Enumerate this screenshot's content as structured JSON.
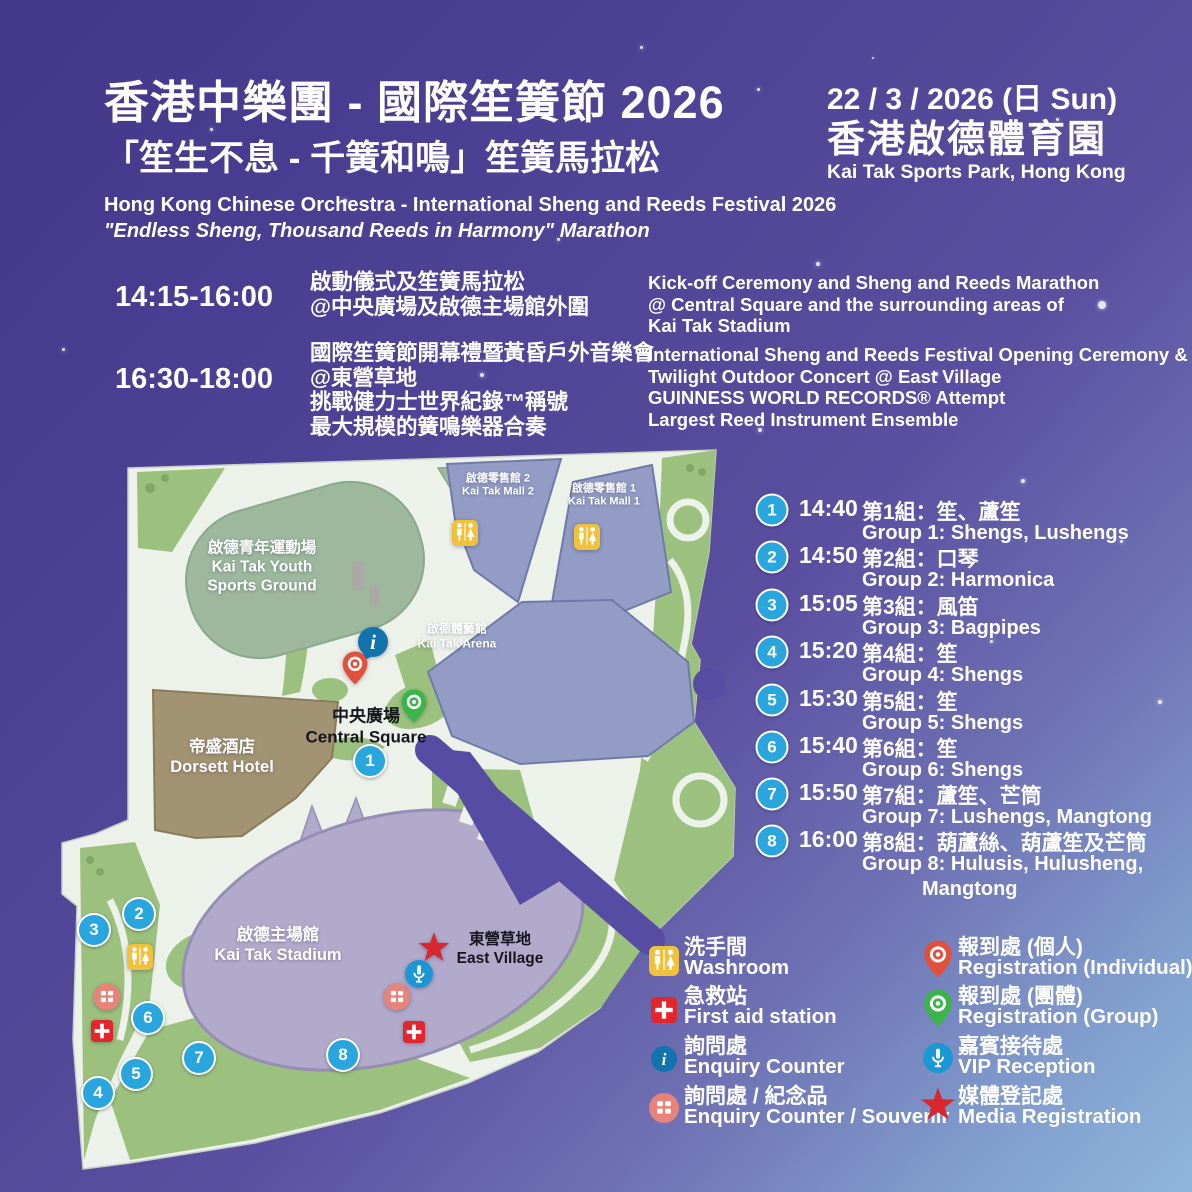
{
  "header": {
    "title_zh": "香港中樂團 - 國際笙簧節 2026",
    "subtitle_zh": "「笙生不息 - 千簧和鳴」笙簧馬拉松",
    "title_en": "Hong Kong Chinese Orchestra - International Sheng and Reeds Festival 2026",
    "subtitle_en": "\"Endless Sheng, Thousand Reeds in Harmony\" Marathon",
    "date": "22 / 3 / 2026 (日 Sun)",
    "venue_zh": "香港啟德體育園",
    "venue_en": "Kai Tak Sports Park, Hong Kong"
  },
  "schedule": [
    {
      "time": "14:15-16:00",
      "zh1": "啟動儀式及笙簧馬拉松",
      "zh2": "@中央廣場及啟德主場館外圍",
      "en1": "Kick-off Ceremony and Sheng and Reeds Marathon",
      "en2": "@ Central Square and the surrounding areas of",
      "en3": "Kai Tak Stadium"
    },
    {
      "time": "16:30-18:00",
      "zh1": "國際笙簧節開幕禮暨黃昏戶外音樂會",
      "zh2": "@東營草地",
      "zh3": "挑戰健力士世界紀錄™稱號",
      "zh4": "最大規模的簧鳴樂器合奏",
      "en1": "International Sheng and Reeds Festival Opening Ceremony &",
      "en2": "Twilight Outdoor Concert @ East Village",
      "en3": "GUINNESS WORLD RECORDS® Attempt",
      "en4": "Largest Reed Instrument Ensemble"
    }
  ],
  "groups": [
    {
      "num": "1",
      "time": "14:40",
      "zh": "第1組：笙、蘆笙",
      "en": "Group 1: Shengs, Lushengs"
    },
    {
      "num": "2",
      "time": "14:50",
      "zh": "第2組：口琴",
      "en": "Group 2: Harmonica"
    },
    {
      "num": "3",
      "time": "15:05",
      "zh": "第3組：風笛",
      "en": "Group 3: Bagpipes"
    },
    {
      "num": "4",
      "time": "15:20",
      "zh": "第4組：笙",
      "en": "Group 4: Shengs"
    },
    {
      "num": "5",
      "time": "15:30",
      "zh": "第5組：笙",
      "en": "Group 5: Shengs"
    },
    {
      "num": "6",
      "time": "15:40",
      "zh": "第6組：笙",
      "en": "Group 6: Shengs"
    },
    {
      "num": "7",
      "time": "15:50",
      "zh": "第7組：蘆笙、芒筒",
      "en": "Group 7: Lushengs, Mangtong"
    },
    {
      "num": "8",
      "time": "16:00",
      "zh": "第8組：葫蘆絲、葫蘆笙及芒筒",
      "en": "Group 8: Hulusis, Hulusheng,",
      "en2": "Mangtong"
    }
  ],
  "map": {
    "numbered": [
      "1",
      "2",
      "3",
      "4",
      "5",
      "6",
      "7",
      "8"
    ],
    "labels": {
      "mall2_zh": "啟德零售館 2",
      "mall2_en": "Kai Tak Mall 2",
      "mall1_zh": "啟德零售館 1",
      "mall1_en": "Kai Tak Mall 1",
      "youth_zh": "啟德青年運動場",
      "youth_en1": "Kai Tak Youth",
      "youth_en2": "Sports Ground",
      "arena_zh": "啟德體藝館",
      "arena_en": "Kai Tak Arena",
      "hotel_zh": "帝盛酒店",
      "hotel_en": "Dorsett Hotel",
      "square_zh": "中央廣場",
      "square_en": "Central Square",
      "stadium_zh": "啟德主場館",
      "stadium_en": "Kai Tak Stadium",
      "village_zh": "東營草地",
      "village_en": "East Village"
    }
  },
  "legend": {
    "left": [
      {
        "zh": "洗手間",
        "en": "Washroom"
      },
      {
        "zh": "急救站",
        "en": "First aid station"
      },
      {
        "zh": "詢問處",
        "en": "Enquiry Counter"
      },
      {
        "zh": "詢問處 / 紀念品",
        "en": "Enquiry Counter / Souvenir"
      }
    ],
    "right": [
      {
        "zh": "報到處 (個人)",
        "en": "Registration (Individual)"
      },
      {
        "zh": "報到處 (團體)",
        "en": "Registration (Group)"
      },
      {
        "zh": "嘉賓接待處",
        "en": "VIP Reception"
      },
      {
        "zh": "媒體登記處",
        "en": "Media Registration"
      }
    ]
  },
  "colors": {
    "background_top": "#43378a",
    "background_bottom": "#8fb6dc",
    "marker_blue": "#2aa6de",
    "washroom_yellow": "#f0c23c",
    "firstaid_red": "#e3262c",
    "enquiry_blue": "#1373ac",
    "souvenir_salmon": "#e8837a",
    "pin_red": "#e2503b",
    "pin_green": "#3bb54a",
    "vip_blue": "#1b97d4",
    "star_red": "#d7282f",
    "map_base": "#ecf1ea",
    "map_green": "#9cc17e",
    "stadium_purple": "#b2aacb",
    "building_bluegray": "#939cc4",
    "hotel_brown": "#a29372"
  }
}
